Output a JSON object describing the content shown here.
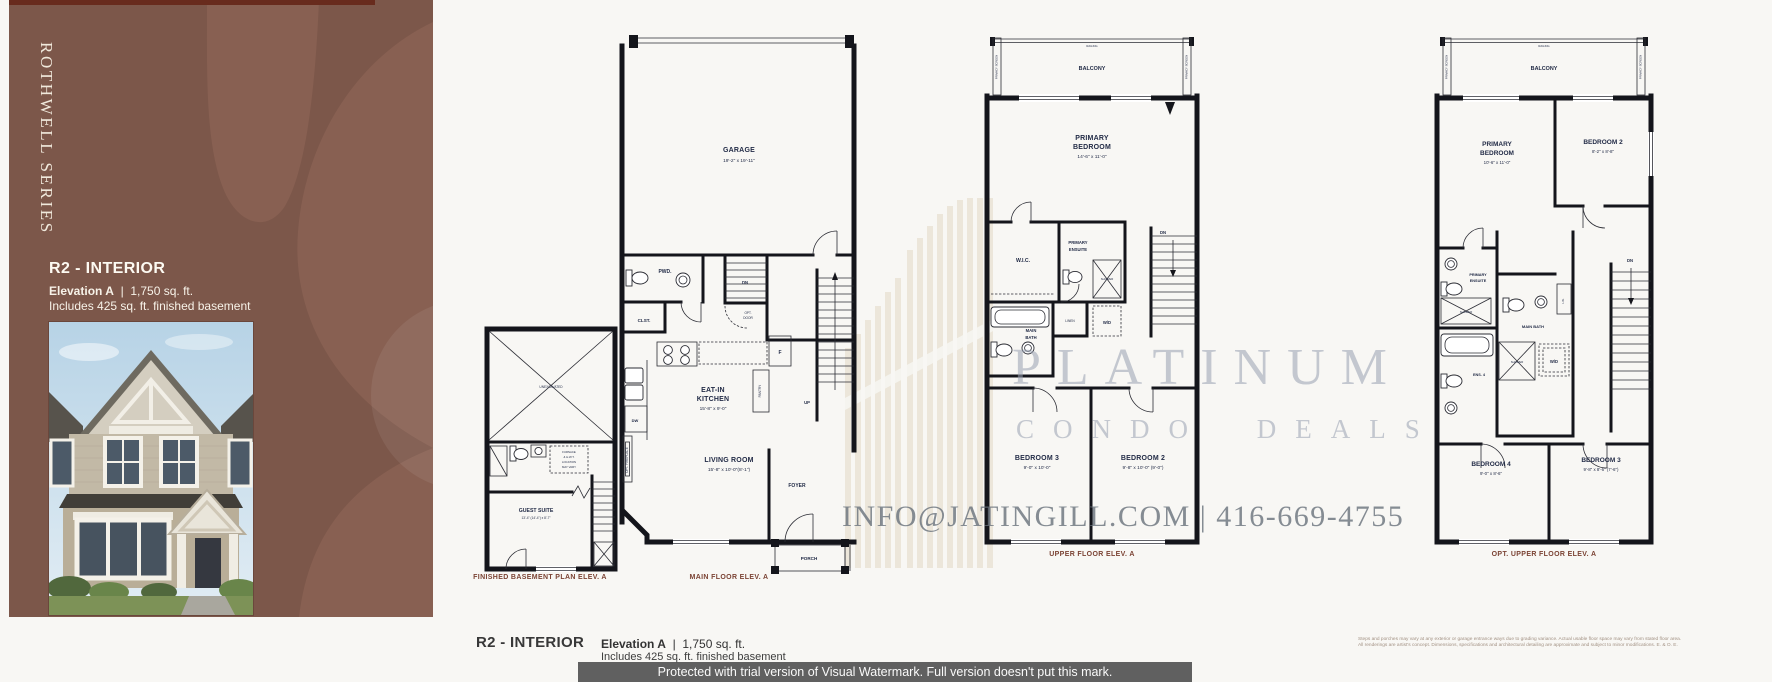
{
  "sidebar": {
    "series": "ROTHWELL SERIES",
    "title": "R2 - INTERIOR",
    "elevation": "Elevation A",
    "sep": "|",
    "sqft": "1,750 sq. ft.",
    "includes": "Includes 425 sq. ft. finished basement",
    "colors": {
      "panel": "#7c574a",
      "monogram": "#886052",
      "top_bar": "#682b1d"
    }
  },
  "plans": {
    "basement": {
      "caption": "FINISHED BASEMENT PLAN ELEV. A",
      "unexcavated": "UNEXCAVATED",
      "note1": "FURNACE",
      "note2": "& H.W.T.",
      "note3": "LOCATION",
      "note4": "MAY VARY",
      "guest": "GUEST SUITE",
      "guest_dims": "13'-4\" (14'-4\") x 8'-7\""
    },
    "main": {
      "caption": "MAIN FLOOR ELEV. A",
      "garage": "GARAGE",
      "garage_dims": "19'-2\" x 19'-11\"",
      "pwd": "PWD.",
      "clst": "CLST.",
      "dn": "DN",
      "opt_door1": "OPT.",
      "opt_door2": "DOOR",
      "eatin1": "EAT-IN",
      "eatin2": "KITCHEN",
      "eatin_dims": "15'-8\" x 9'-0\"",
      "dw": "DW",
      "fridge": "F",
      "pantry": "PANTRY",
      "up": "UP",
      "fireplace": "OPT. FIREPLACE",
      "living": "LIVING ROOM",
      "living_dims": "15'-8\" x 10'-0\"(8'-1\")",
      "foyer": "FOYER",
      "porch": "PORCH"
    },
    "upper": {
      "caption": "UPPER FLOOR ELEV. A",
      "railing": "RAILING",
      "privacy": "PRIVACY SCREEN",
      "balcony": "BALCONY",
      "primary1": "PRIMARY",
      "primary2": "BEDROOM",
      "primary_dims": "14'-6\" x 11'-0\"",
      "wic": "W.I.C.",
      "ensuite1": "PRIMARY",
      "ensuite2": "ENSUITE",
      "shower": "SHOWER",
      "mainbath1": "MAIN",
      "mainbath2": "BATH",
      "linen": "LINEN",
      "wd": "W/D",
      "dn": "DN",
      "bed3": "BEDROOM 3",
      "bed3_dims": "9'-0\" x 10'-0\"",
      "bed2": "BEDROOM 2",
      "bed2_dims": "9'-8\" x 10'-0\" (9'-0\")"
    },
    "opt_upper": {
      "caption": "OPT. UPPER FLOOR ELEV. A",
      "railing": "RAILING",
      "privacy": "PRIVACY SCREEN",
      "balcony": "BALCONY",
      "primary1": "PRIMARY",
      "primary2": "BEDROOM",
      "primary_dims": "10'-6\" x 11'-0\"",
      "bed2": "BEDROOM 2",
      "bed2_dims": "8'-2\" x 8'-8\"",
      "ensuite1": "PRIMARY",
      "ensuite2": "ENSUITE",
      "shower": "SHOWER",
      "mainbath": "MAIN BATH",
      "lin": "LIN.",
      "ens4": "ENS. 4",
      "wd": "W/D",
      "dn": "DN",
      "bed4": "BEDROOM 4",
      "bed4_dims": "9'-0\" x 8'-6\"",
      "bed3": "BEDROOM 3",
      "bed3_dims": "9'-8\" x 8'-6\" (7'-6\")"
    }
  },
  "watermark": {
    "brand1": "PLATINUM",
    "brand2": "CONDO DEALS",
    "contact": "INFO@JATINGILL.COM | 416-669-4755",
    "banner": "Protected with trial version of Visual Watermark. Full version doesn't put this mark."
  },
  "footer": {
    "title": "R2 - INTERIOR",
    "elevation": "Elevation A",
    "sep": "|",
    "sqft": "1,750 sq. ft.",
    "includes": "Includes 425 sq. ft. finished basement",
    "disc1": "Steps and porches may vary at any exterior or garage entrance ways due to grading variance. Actual usable floor space may vary from stated floor area.",
    "disc2": "All renderings are artist's concept. Dimensions, specifications and architectural detailing are approximate and subject to minor modifications. E. & O. E."
  }
}
